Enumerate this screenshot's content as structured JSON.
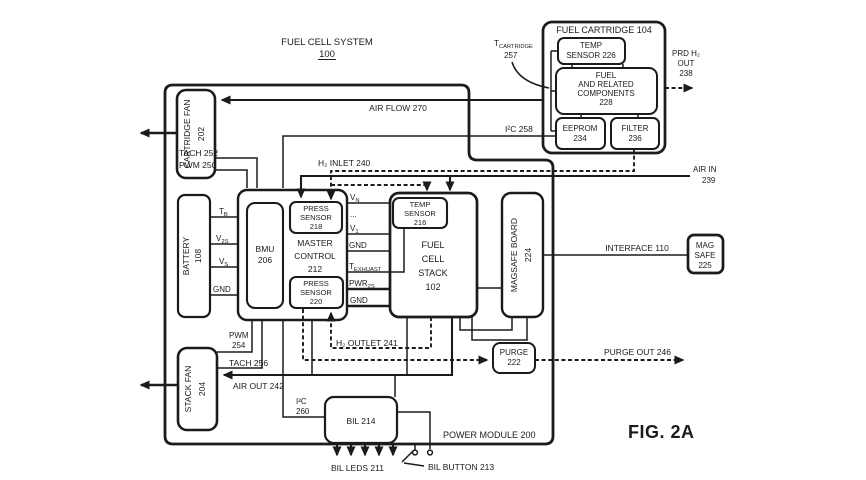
{
  "figure": {
    "fig_label": "FIG. 2A",
    "system_title": "FUEL CELL SYSTEM",
    "system_number": "100"
  },
  "modules": {
    "power_module": "POWER MODULE 200",
    "fuel_cartridge": "FUEL CARTRIDGE 104",
    "temp_sensor_226": {
      "l1": "TEMP",
      "l2": "SENSOR 226"
    },
    "fuel_components": {
      "l1": "FUEL",
      "l2": "AND RELATED",
      "l3": "COMPONENTS",
      "l4": "228"
    },
    "eeprom": {
      "l1": "EEPROM",
      "l2": "234"
    },
    "filter": {
      "l1": "FILTER",
      "l2": "236"
    },
    "cartridge_fan": {
      "name": "CARTRIDGE FAN",
      "num": "202"
    },
    "stack_fan": {
      "name": "STACK FAN",
      "num": "204"
    },
    "battery": {
      "name": "BATTERY",
      "num": "108"
    },
    "bmu": {
      "l1": "BMU",
      "l2": "206"
    },
    "master_control": {
      "l1": "MASTER",
      "l2": "CONTROL",
      "l3": "212"
    },
    "press_sensor_218": {
      "l1": "PRESS",
      "l2": "SENSOR",
      "l3": "218"
    },
    "press_sensor_220": {
      "l1": "PRESS",
      "l2": "SENSOR",
      "l3": "220"
    },
    "temp_sensor_216": {
      "l1": "TEMP",
      "l2": "SENSOR",
      "l3": "216"
    },
    "fuel_cell_stack": {
      "l1": "FUEL",
      "l2": "CELL",
      "l3": "STACK",
      "l4": "102"
    },
    "magsafe_board": {
      "name": "MAGSAFE BOARD",
      "num": "224"
    },
    "mag_safe": {
      "l1": "MAG",
      "l2": "SAFE",
      "l3": "225"
    },
    "purge": {
      "l1": "PURGE",
      "l2": "222"
    },
    "bil": "BIL 214"
  },
  "signals": {
    "air_flow": "AIR FLOW 270",
    "i2c_258": "I²C 258",
    "h2_inlet": "H₂ INLET 240",
    "h2_outlet": "H₂ OUTLET 241",
    "air_in": {
      "l1": "AIR IN",
      "l2": "239"
    },
    "air_out": "AIR OUT 242",
    "prd_h2_out": {
      "l1": "PRD H₂",
      "l2": "OUT",
      "l3": "238"
    },
    "t_cartridge": {
      "main": "T",
      "sub": "CARTRIDGE",
      "num": "257"
    },
    "tach_252": "TACH 252",
    "pwm_250": "PWM 250",
    "pwm_254": {
      "l1": "PWM",
      "l2": "254"
    },
    "tach_256": "TACH 256",
    "t_b": {
      "main": "T",
      "sub": "B"
    },
    "v_2s": {
      "main": "V",
      "sub": "2S"
    },
    "v_s": {
      "main": "V",
      "sub": "S"
    },
    "gnd_battery": "GND",
    "v_n": {
      "main": "V",
      "sub": "N"
    },
    "dots": "...",
    "v_1": {
      "main": "V",
      "sub": "1"
    },
    "gnd_stack_1": "GND",
    "t_exhaust": {
      "main": "T",
      "sub": "EXHUAST"
    },
    "pwr_2s": {
      "main": "PWR",
      "sub": "2S"
    },
    "gnd_stack_2": "GND",
    "interface_110": "INTERFACE 110",
    "purge_out": "PURGE OUT 246",
    "i2c_260": {
      "l1": "I²C",
      "l2": "260"
    },
    "bil_leds": "BIL LEDS 211",
    "bil_button": "BIL BUTTON 213"
  },
  "colors": {
    "ink": "#1b1b1b",
    "background": "#ffffff"
  }
}
